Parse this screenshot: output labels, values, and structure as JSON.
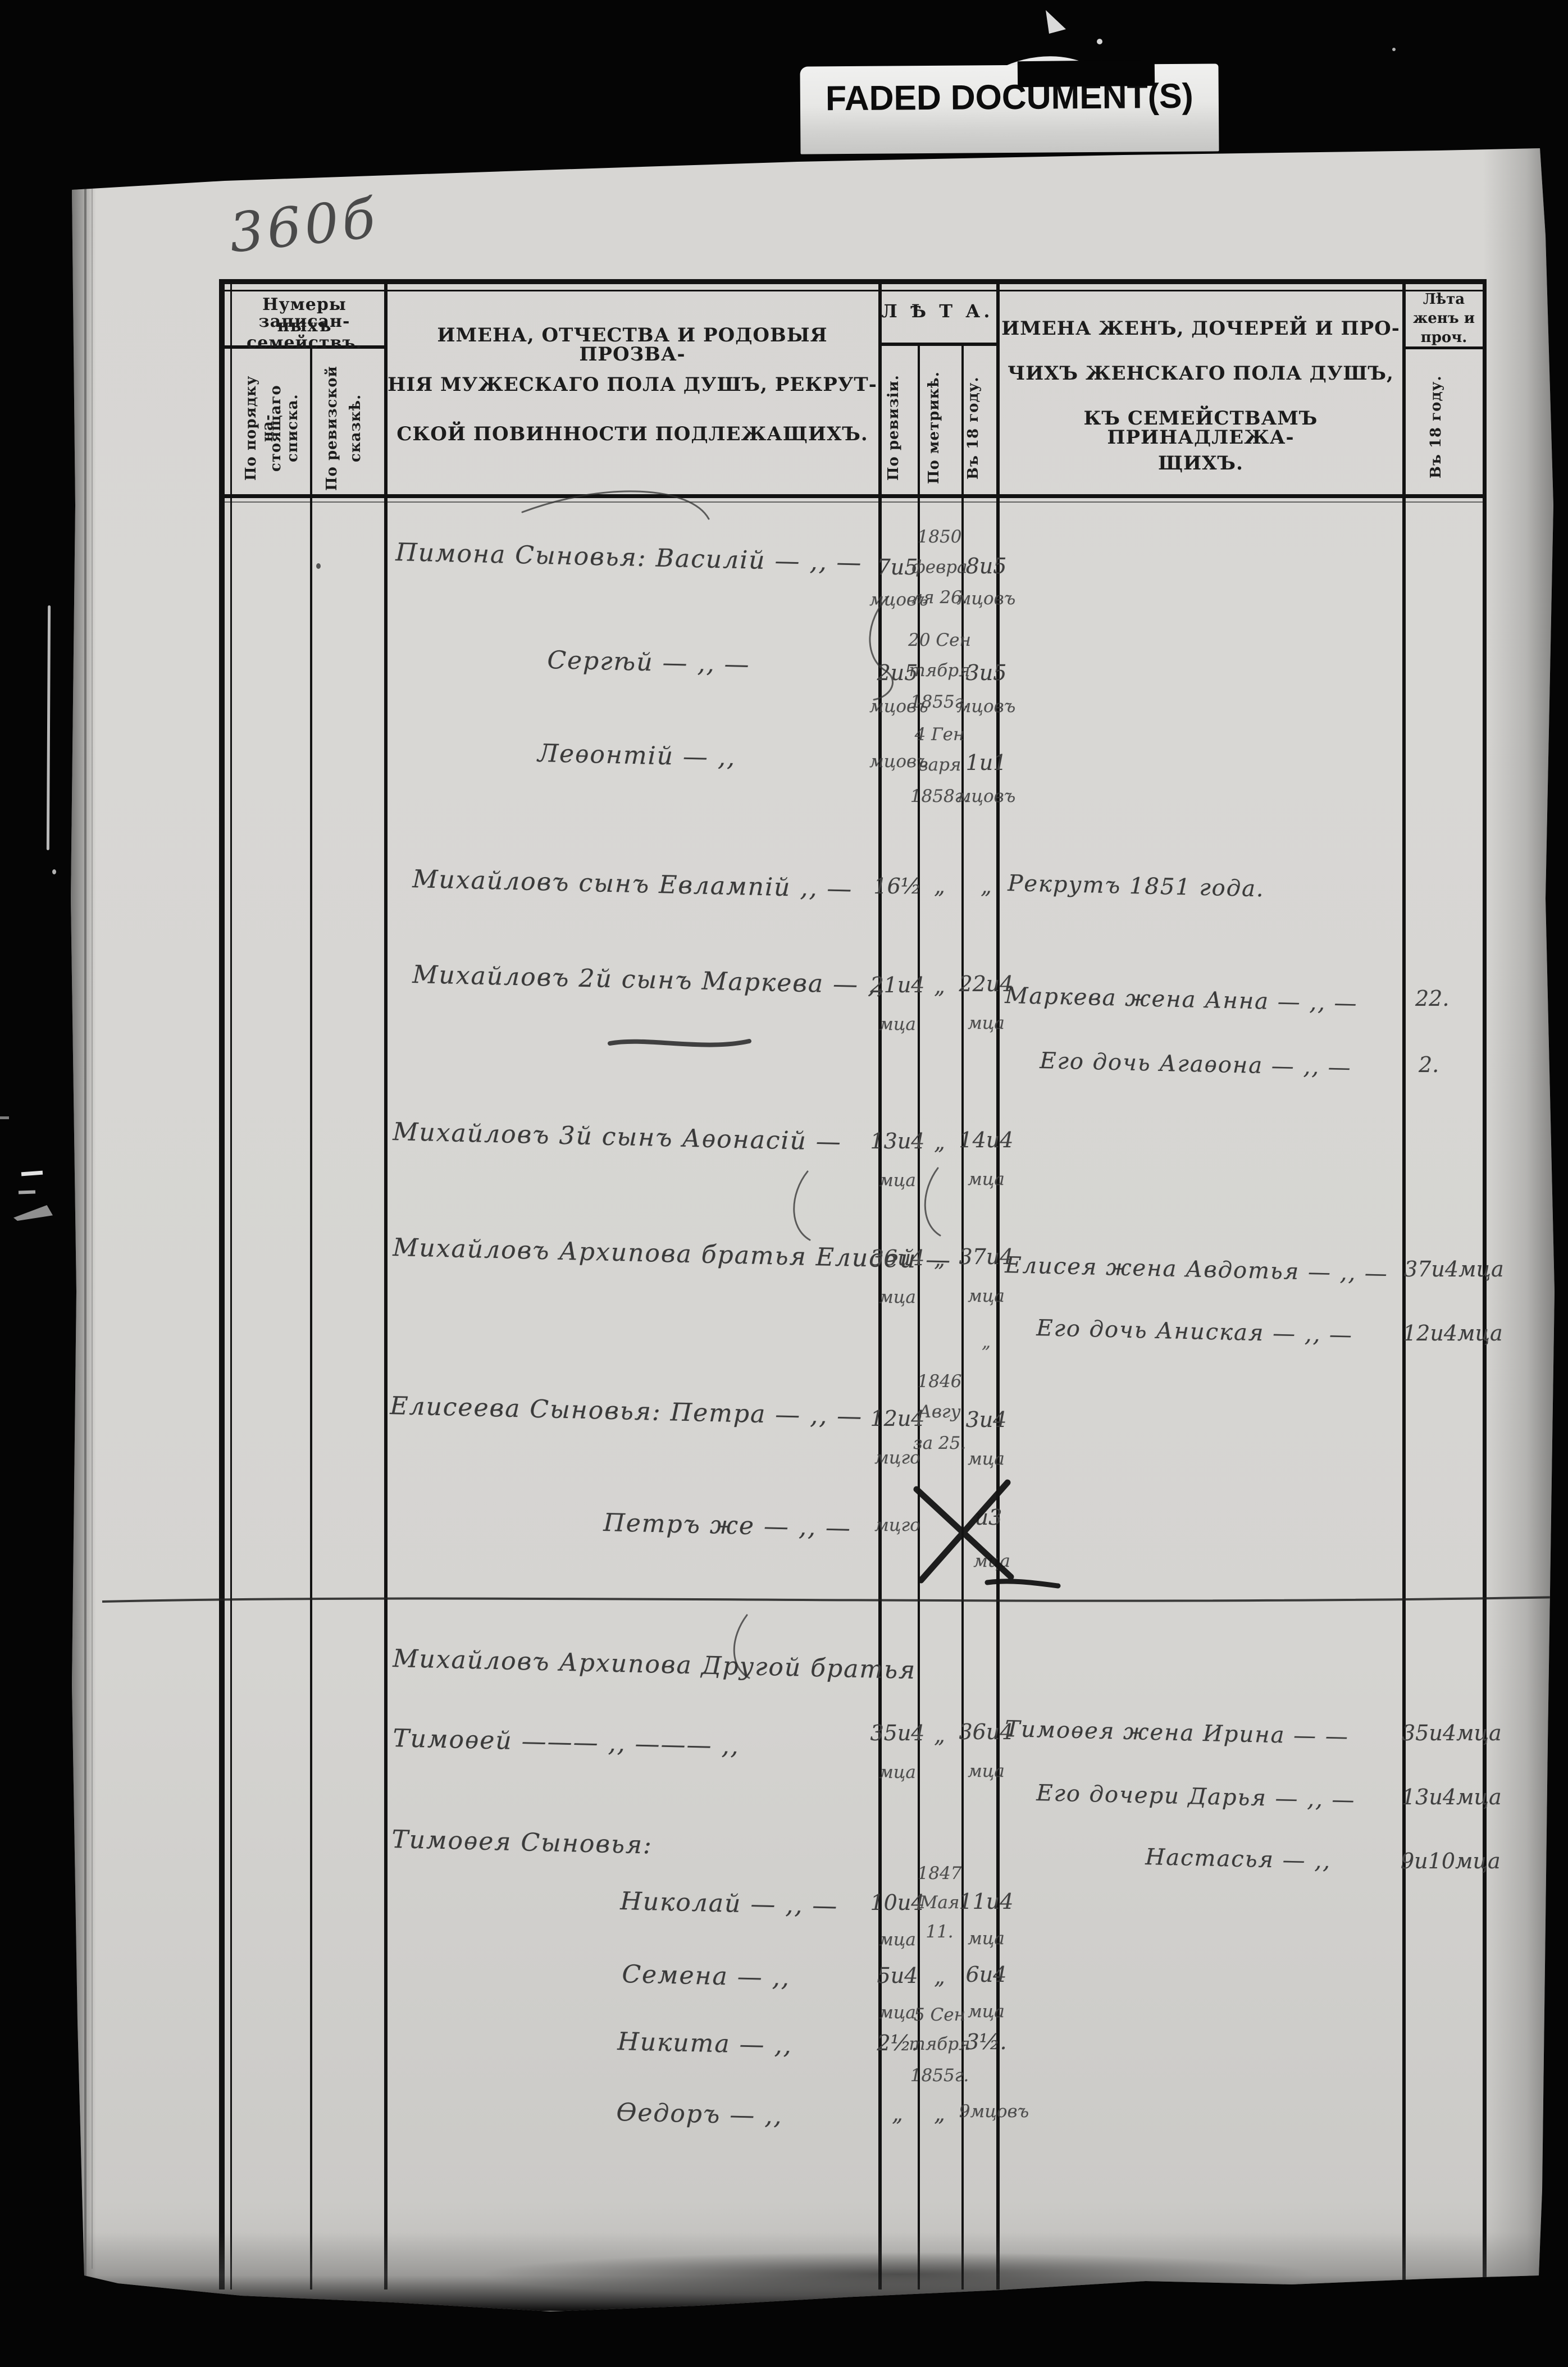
{
  "film": {
    "label": "FADED DOCUMENT(S)"
  },
  "page": {
    "number": "360б"
  },
  "header": {
    "numbers_group_line1": "Нумеры записан-",
    "numbers_group_line2": "ныхъ семействъ.",
    "col_order_line1": "По порядку на-",
    "col_order_line2": "стоящаго списка.",
    "col_revtale_line1": "По ревизской",
    "col_revtale_line2": "сказкѣ.",
    "male_title_line1": "ИМЕНА, ОТЧЕСТВА И РОДОВЫЯ ПРОЗВА-",
    "male_title_line2": "НІЯ МУЖЕСКАГО ПОЛА ДУШЪ, РЕКРУТ-",
    "male_title_line3": "СКОЙ ПОВИННОСТИ ПОДЛЕЖАЩИХЪ.",
    "age_group_title": "Л Ѣ Т А.",
    "col_by_revision": "По ревизіи.",
    "col_by_metric": "По метрикѣ.",
    "col_in_year": "Въ 18     году.",
    "female_title_line1": "ИМЕНА ЖЕНЪ, ДОЧЕРЕЙ И ПРО-",
    "female_title_line2": "ЧИХЪ ЖЕНСКАГО ПОЛА ДУШЪ,",
    "female_title_line3": "КЪ СЕМЕЙСТВАМЪ ПРИНАДЛЕЖА-",
    "female_title_line4": "ЩИХЪ.",
    "female_age_line1": "Лѣта",
    "female_age_line2": "женъ и",
    "female_age_line3": "проч.",
    "female_age_in_year": "Въ 18     году."
  },
  "rows": [
    {
      "name": "Пимона Сыновья: Василій — ‚‚ —",
      "rev1": "7и5",
      "rev2": "мцовъ",
      "m1": "1850",
      "m2": "февра",
      "m3": "ля 26.",
      "y1": "8и5",
      "y2": "мцовъ"
    },
    {
      "name": "Сергѣй — ‚‚ —",
      "rev1": "2и5",
      "rev2": "мцовъ",
      "m1": "20 Сен",
      "m2": "тября",
      "m3": "1855г.",
      "y1": "3и5",
      "y2": "мцовъ"
    },
    {
      "name": "Леѳонтій — ‚‚",
      "rev2": "мцовъ",
      "m1": "4 Ген",
      "m2": "варя",
      "m3": "1858г.",
      "y1": "1и1",
      "y2": "мцовъ"
    },
    {
      "name": "Михайловъ сынъ Евлампій ‚‚ —",
      "rev1": "16½",
      "m1": "„",
      "y1": "„"
    },
    {
      "name": "Михайловъ 2й сынъ Маркева — ‚‚",
      "rev1": "21и4",
      "rev2": "мца",
      "m1": "„",
      "y1": "22и4",
      "y2": "мца"
    },
    {
      "name": "Михайловъ 3й сынъ Аѳонасій —",
      "rev1": "13и4",
      "rev2": "мца",
      "m1": "„",
      "y1": "14и4",
      "y2": "мца"
    },
    {
      "name": "Михайловъ Архипова братья Елисей —",
      "rev1": "36и4",
      "rev2": "мца",
      "m1": "„",
      "y1": "37и4",
      "y2": "мца",
      "y3": "„"
    },
    {
      "name": "Елисеева Сыновья: Петра — ‚‚ —",
      "rev1": "12и4",
      "rev2": "мцго",
      "m1": "1846",
      "m2": "Авгу",
      "m3": "за 25.",
      "y1": "3и4",
      "y2": "мца"
    },
    {
      "name": "Петръ же — ‚‚ —",
      "rev2": "мцго",
      "y1": "и3",
      "y2": "мца"
    },
    {
      "name": "Михайловъ Архипова Другой братья"
    },
    {
      "name": "Тимоѳей ——— ‚‚ ——— ‚‚",
      "rev1": "35и4",
      "rev2": "мца",
      "m1": "„",
      "y1": "36и4",
      "y2": "мца"
    },
    {
      "name": "Тимоѳея Сыновья:"
    },
    {
      "name": "Николай — ‚‚ —",
      "rev1": "10и4",
      "rev2": "мца",
      "m1": "1847",
      "m2": "Мая",
      "m3": "11.",
      "y1": "11и4",
      "y2": "мца"
    },
    {
      "name": "Семена — ‚‚",
      "rev1": "5и4",
      "rev2": "мца",
      "m1": "„",
      "y1": "6и4",
      "y2": "мца"
    },
    {
      "name": "Никита — ‚‚",
      "rev1": "2½.",
      "m1": "5 Сен",
      "m2": "тября",
      "m3": "1855г.",
      "y1": "3½."
    },
    {
      "name": "Ѳедоръ — ‚‚",
      "rev1": "„",
      "m1": "„",
      "y1": "9мцовъ"
    }
  ],
  "females": [
    {
      "text": "Рекрутъ 1851 года.",
      "age": ""
    },
    {
      "text": "Маркева жена Анна — ‚‚ —",
      "age": "22."
    },
    {
      "text": "Его дочь Агаѳона — ‚‚ —",
      "age": "2."
    },
    {
      "text": "Елисея жена Авдотья — ‚‚ —",
      "age": "37и4мца"
    },
    {
      "text": "Его дочь Аниская — ‚‚ —",
      "age": "12и4мца"
    },
    {
      "text": "Тимоѳея жена Ирина — —",
      "age": "35и4мца"
    },
    {
      "text": "Его дочери Дарья — ‚‚ —",
      "age": "13и4мца"
    },
    {
      "text": "Настасья — ‚‚",
      "age": "9и10мца"
    }
  ]
}
